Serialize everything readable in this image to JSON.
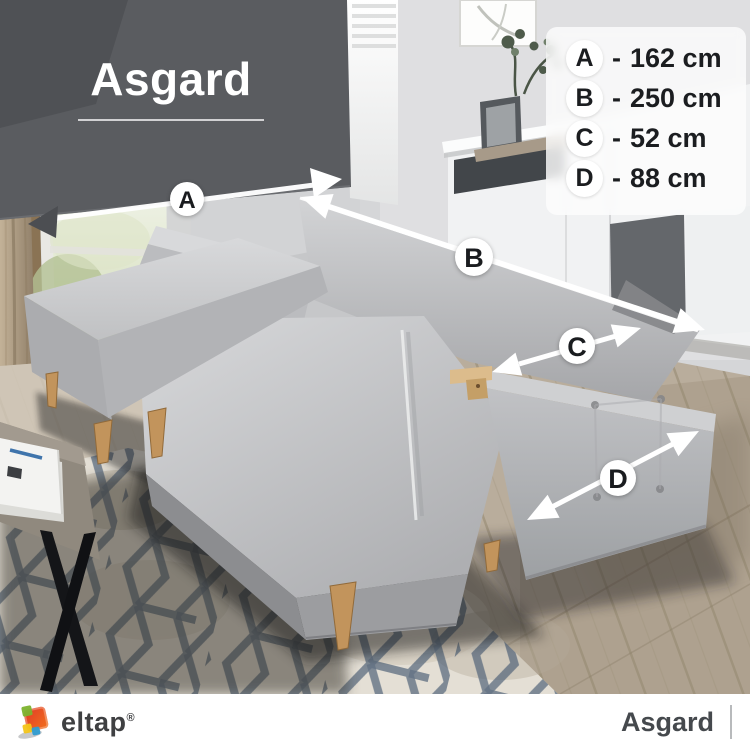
{
  "title": "Asgard",
  "dimensions": [
    {
      "letter": "A",
      "sep": "-",
      "value": "162 cm"
    },
    {
      "letter": "B",
      "sep": "-",
      "value": "250 cm"
    },
    {
      "letter": "C",
      "sep": "-",
      "value": "52 cm"
    },
    {
      "letter": "D",
      "sep": "-",
      "value": "88 cm"
    }
  ],
  "footer": {
    "brand": "eltap",
    "reg": "®",
    "product": "Asgard"
  },
  "colors": {
    "brand_red": "#e03a28",
    "brand_orange": "#f2711c",
    "brand_green": "#7db32e",
    "brand_yellow": "#f3c51a",
    "brand_blue": "#2f9cd0",
    "blind_gray": "#5a5c60",
    "sofa_gray": "#c3c4c6",
    "rug_navy": "#4e6077",
    "arrow_white": "#ffffff"
  }
}
